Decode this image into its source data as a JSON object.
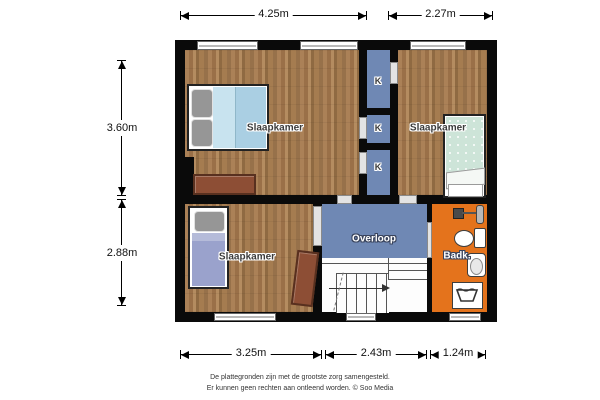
{
  "plan": {
    "rooms": {
      "bedroom_top_left": {
        "label": "Slaapkamer"
      },
      "bedroom_top_right": {
        "label": "Slaapkamer"
      },
      "bedroom_bottom_left": {
        "label": "Slaapkamer"
      },
      "landing": {
        "label": "Overloop"
      },
      "bathroom": {
        "label": "Badk."
      },
      "closets": [
        {
          "label": "K"
        },
        {
          "label": "K"
        },
        {
          "label": "K"
        }
      ]
    },
    "dimensions": {
      "top": [
        {
          "label": "4.25m"
        },
        {
          "label": "2.27m"
        }
      ],
      "left": [
        {
          "label": "3.60m"
        },
        {
          "label": "2.88m"
        }
      ],
      "bottom": [
        {
          "label": "3.25m"
        },
        {
          "label": "2.43m"
        },
        {
          "label": "1.24m"
        }
      ]
    },
    "colors": {
      "wall": "#0a0a0a",
      "wood_floor": "#a57c50",
      "landing_blue": "#6f88b4",
      "bathroom_orange": "#e4731c"
    },
    "icons": {
      "toilet": "toilet-top-view",
      "sink": "sink-top-view",
      "washing_machine": "washing-machine-tub",
      "radiator": "bathroom-accessory",
      "stairs": "staircase-with-direction-arrow",
      "window": "window-in-wall",
      "door": "door-opening"
    }
  },
  "footer": {
    "line1": "De plattegronden zijn met de grootste zorg samengesteld.",
    "line2": "Er kunnen geen rechten aan ontleend worden. © Soo Media"
  }
}
